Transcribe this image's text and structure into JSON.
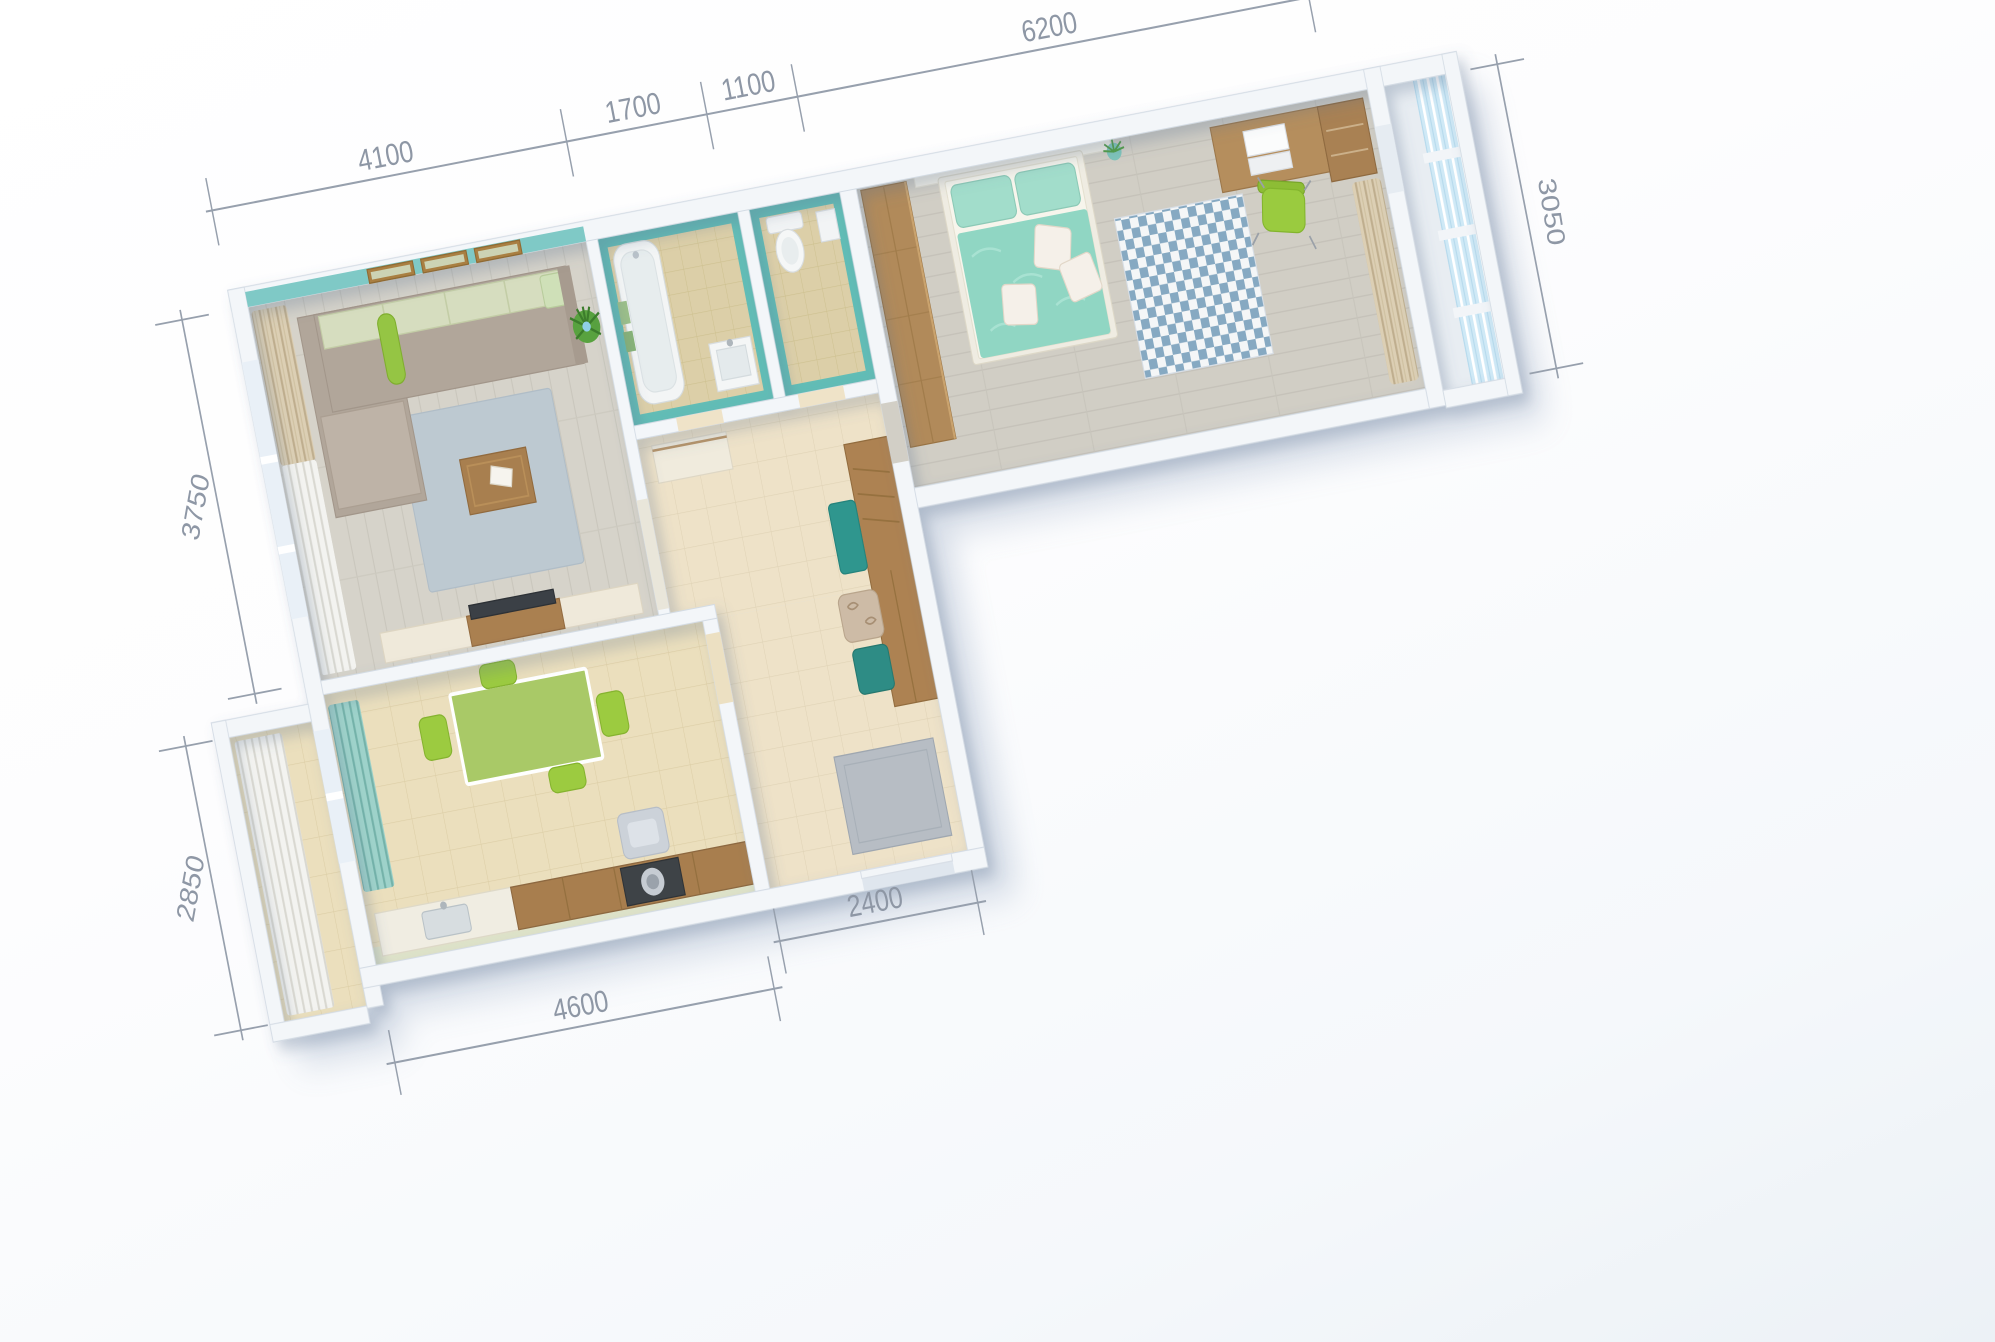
{
  "scene": {
    "description": "Top-down 3D render of a two-room apartment floor plan with architectural dimensions",
    "background": "#fbfcfe",
    "unit": "mm"
  },
  "dimensions": {
    "top": [
      {
        "label": "4100"
      },
      {
        "label": "1700"
      },
      {
        "label": "1100"
      },
      {
        "label": "6200"
      }
    ],
    "left": [
      {
        "label": "3750"
      },
      {
        "label": "2850"
      }
    ],
    "right": [
      {
        "label": "3050"
      }
    ],
    "bottom": [
      {
        "label": "4600"
      },
      {
        "label": "2400"
      }
    ]
  },
  "style": {
    "dimension_color": "#8e97a5",
    "wall_color": "#f3f6f9",
    "accent_teal_wall": "#7fc9c6",
    "bathroom_tile_teal": "#62bdb6",
    "lime_green": "#9acb3f",
    "mint_bedding": "#90d6c3",
    "wood_brown": "#ad8452",
    "living_rug_blue": "#bdc9d1",
    "glass_blue": "#cde9f6",
    "floor_beige_tile": "#ebdfbd"
  },
  "rooms": [
    {
      "name": "living-room",
      "features": [
        "corner-sofa",
        "green-bolster-pillow",
        "coffee-table",
        "magazine",
        "blue-rug",
        "tv-stand",
        "tv",
        "window-curtains",
        "patterned-curtain",
        "three-picture-frames",
        "plant",
        "teal-accent-wall"
      ]
    },
    {
      "name": "kitchen",
      "features": [
        "dining-table",
        "lime-chairs",
        "counter",
        "sink",
        "cooktop",
        "cooker-hood",
        "teal-curtain",
        "window"
      ]
    },
    {
      "name": "bathroom",
      "features": [
        "bathtub",
        "towels",
        "wash-basin",
        "teal-mosaic-walls"
      ]
    },
    {
      "name": "toilet",
      "features": [
        "toilet",
        "corner-basin",
        "teal-mosaic-walls"
      ]
    },
    {
      "name": "bedroom",
      "features": [
        "double-bed",
        "mint-pillows",
        "dotted-pillows",
        "wardrobe",
        "headboard-shelf",
        "plant-pot",
        "desk",
        "laptop",
        "drawer-unit",
        "green-chair",
        "checkered-rug",
        "beige-curtains"
      ]
    },
    {
      "name": "hallway",
      "features": [
        "sideboard",
        "coat-wardrobe",
        "teal-bench",
        "patterned-pouf",
        "teal-ottoman",
        "doormat",
        "entrance-door"
      ]
    },
    {
      "name": "balcony-right",
      "features": [
        "blue-glazing",
        "sills"
      ]
    },
    {
      "name": "balcony-left",
      "features": [
        "white-curtains",
        "tiled-floor"
      ]
    }
  ]
}
